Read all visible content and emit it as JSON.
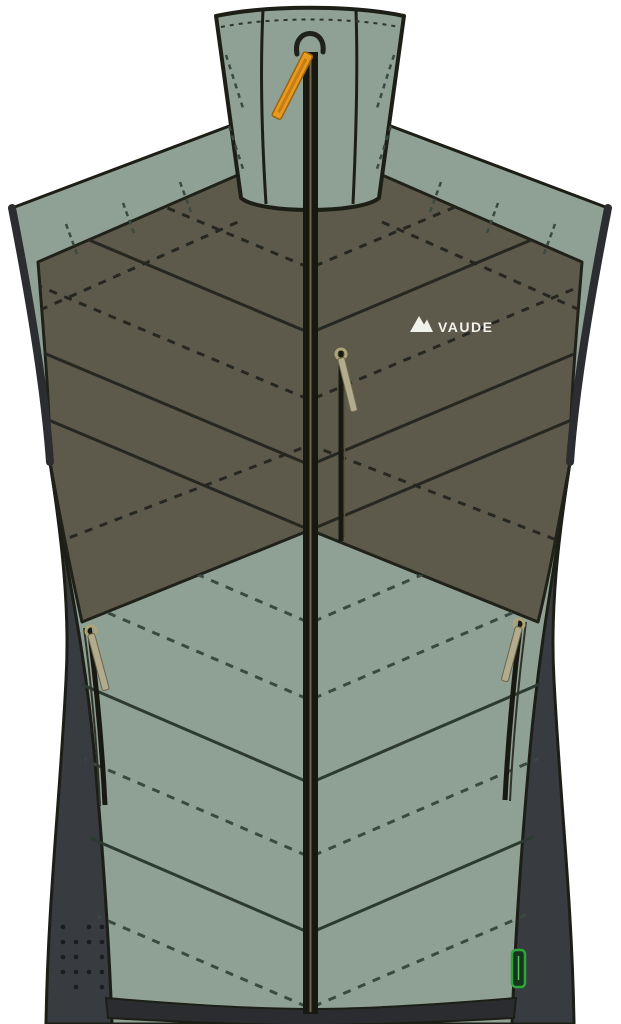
{
  "product": {
    "brand": "VAUDE",
    "alt": "Insulated vest, front view product illustration",
    "logo": {
      "icon": "vaude-mountain-icon",
      "text": "VAUDE"
    },
    "colors": {
      "background": "#FFFFFF",
      "body_green": "#8FA094",
      "chest_olive": "#5E5A4B",
      "side_panel_gray": "#383B40",
      "hem_dark": "#2A2C2F",
      "outline_dark": "#1D1F16",
      "quilt_line_olive": "#262720",
      "quilt_line_green": "#3A4A40",
      "zipper_band": "#17180F",
      "zipper_pull_orange": "#E8991F",
      "pull_tab_tan": "#B3AB8E",
      "hang_tag_green": "#2FA43C",
      "hang_tag_fill": "#16351C",
      "logo_white": "#F2F2EC",
      "dot_color": "#1A1C1F"
    },
    "features": {
      "collar": "stand-up-collar",
      "main_zipper": "center-front-zipper",
      "chest_pocket": "vertical-chest-pocket-zipper",
      "left_pocket": "left-side-pocket-zipper",
      "right_pocket": "right-side-pocket-zipper",
      "hang_tag": "green-hang-tag",
      "dot_pattern": "perforated-dot-grid"
    }
  }
}
